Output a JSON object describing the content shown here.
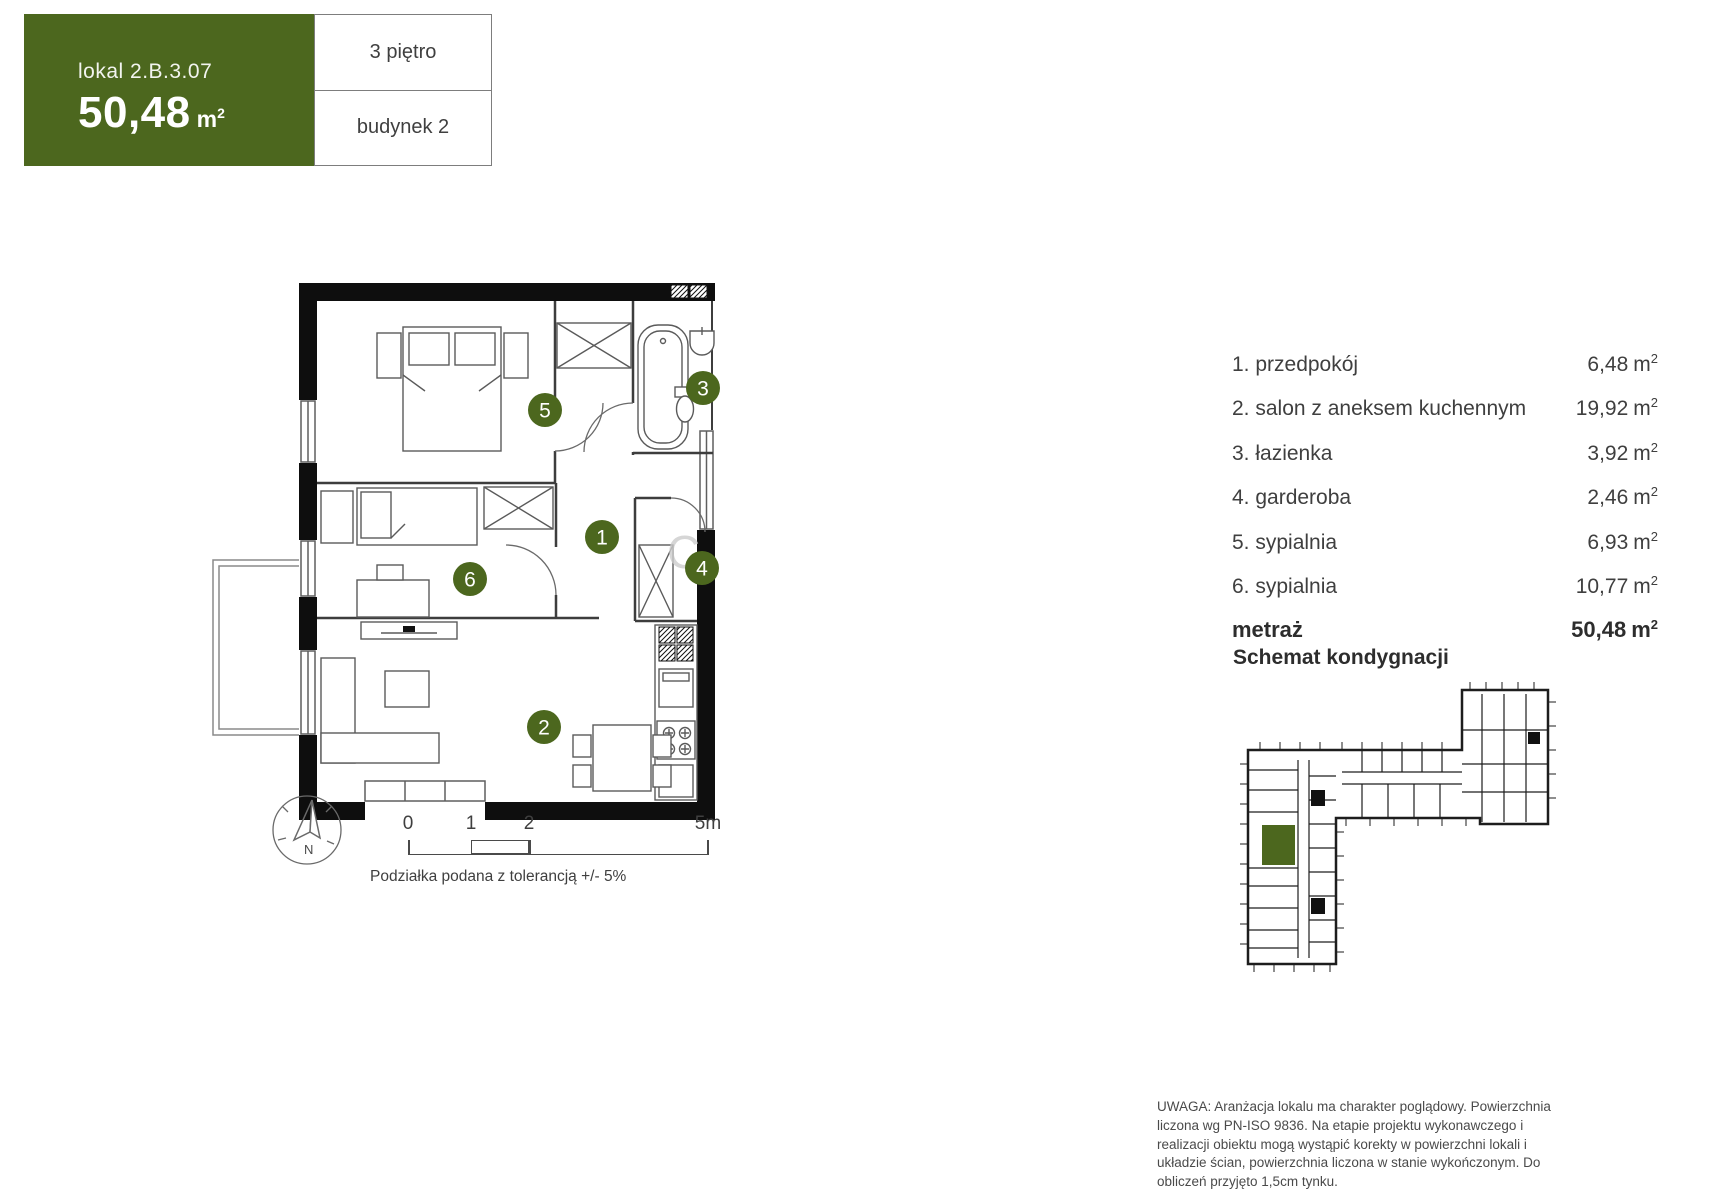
{
  "header": {
    "unit_label": "lokal 2.B.3.07",
    "area_value": "50,48",
    "floor": "3 piętro",
    "building": "budynek 2"
  },
  "units": {
    "m": "m",
    "sup": "2"
  },
  "plan": {
    "room_numbers": [
      "1",
      "2",
      "3",
      "4",
      "5",
      "6"
    ],
    "watermark": "C",
    "compass_n": "N",
    "scale_ticks": [
      "0",
      "1",
      "2",
      "5m"
    ],
    "scale_caption": "Podziałka podana z tolerancją +/- 5%"
  },
  "room_list": {
    "rows": [
      {
        "name": "1. przedpokój",
        "area": "6,48"
      },
      {
        "name": "2. salon z aneksem kuchennym",
        "area": "19,92"
      },
      {
        "name": "3. łazienka",
        "area": "3,92"
      },
      {
        "name": "4. garderoba",
        "area": "2,46"
      },
      {
        "name": "5. sypialnia",
        "area": "6,93"
      },
      {
        "name": "6. sypialnia",
        "area": "10,77"
      }
    ],
    "total_label": "metraż",
    "total_area": "50,48"
  },
  "schematic": {
    "title": "Schemat kondygnacji"
  },
  "disclaimer": "UWAGA: Aranżacja lokalu ma charakter poglądowy. Powierzchnia liczona wg PN-ISO 9836. Na etapie projektu wykonawczego i realizacji obiektu mogą wystąpić korekty w powierzchni lokali i układzie ścian, powierzchnia liczona w stanie wykończonym. Do obliczeń przyjęto 1,5cm tynku.",
  "colors": {
    "accent_green": "#4c671e",
    "wall": "#0e0e0e",
    "text": "#3f3f3f"
  }
}
